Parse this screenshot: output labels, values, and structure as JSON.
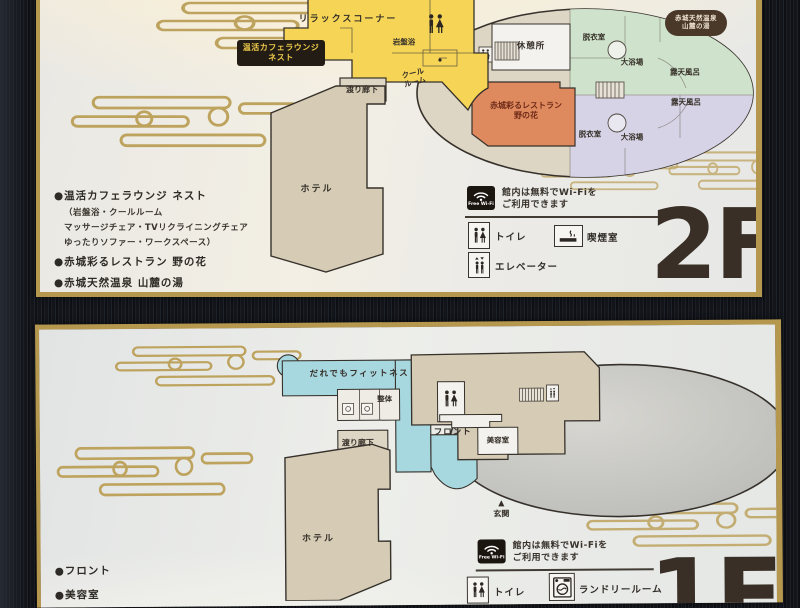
{
  "palette": {
    "frame_dark": "#13151a",
    "gold_trim": "#b6974e",
    "cloud_gold": "#bda35e",
    "lounge_yellow": "#f6d556",
    "bath_green": "#cfe2cb",
    "bath_lavender": "#d7d3e6",
    "restaurant_orange": "#df8a5e",
    "building_tan": "#d6ccb6",
    "oval_beige": "#ded6c4",
    "fitness_blue": "#a7d7df",
    "badge_brown": "#4a3829",
    "badge_black": "#221c15",
    "text_dark": "#352f28"
  },
  "floor2": {
    "floor_label": "2F",
    "onsen_badge": {
      "line1": "赤城天然温泉",
      "line2": "山麓の湯"
    },
    "nest_badge": {
      "line1": "温活カフェラウンジ",
      "line2": "ネスト"
    },
    "rooms": {
      "relax": "リラックスコーナー",
      "ganbanyoku": "岩盤浴",
      "cool_room_l1": "クール",
      "cool_room_l2": "ルーム",
      "corridor": "渡り廊下",
      "hotel": "ホテル",
      "rest_area": "休憩所",
      "dressing_top": "脱衣室",
      "bath_top": "大浴場",
      "rotenburo_top": "露天風呂",
      "rotenburo_bottom": "露天風呂",
      "bath_bottom": "大浴場",
      "dressing_bottom": "脱衣室",
      "restaurant_l1": "赤城彩るレストラン",
      "restaurant_l2": "野の花"
    },
    "directory": {
      "item1": "●温活カフェラウンジ ネスト",
      "note1": "（岩盤浴・クールルーム",
      "note2": "マッサージチェア・TVリクライニングチェア",
      "note3": "ゆったりソファー・ワークスペース）",
      "item2": "●赤城彩るレストラン 野の花",
      "item3": "●赤城天然温泉 山麓の湯"
    },
    "wifi": {
      "badge": "Free Wi-Fi",
      "line1": "館内は無料でWi-Fiを",
      "line2": "ご利用できます"
    },
    "legend": {
      "toilet": "トイレ",
      "smoking": "喫煙室",
      "elevator": "エレベーター"
    }
  },
  "floor1": {
    "floor_label": "1F",
    "rooms": {
      "fitness": "だれでもフィットネス",
      "seitai": "整体",
      "front": "フロント",
      "beauty": "美容室",
      "corridor": "渡り廊下",
      "hotel": "ホテル",
      "entrance_marker": "▲",
      "entrance": "玄関"
    },
    "directory": {
      "item1": "●フロント",
      "item2": "●美容室"
    },
    "wifi": {
      "badge": "Free Wi-Fi",
      "line1": "館内は無料でWi-Fiを",
      "line2": "ご利用できます"
    },
    "legend": {
      "toilet": "トイレ",
      "laundry": "ランドリールーム"
    }
  }
}
